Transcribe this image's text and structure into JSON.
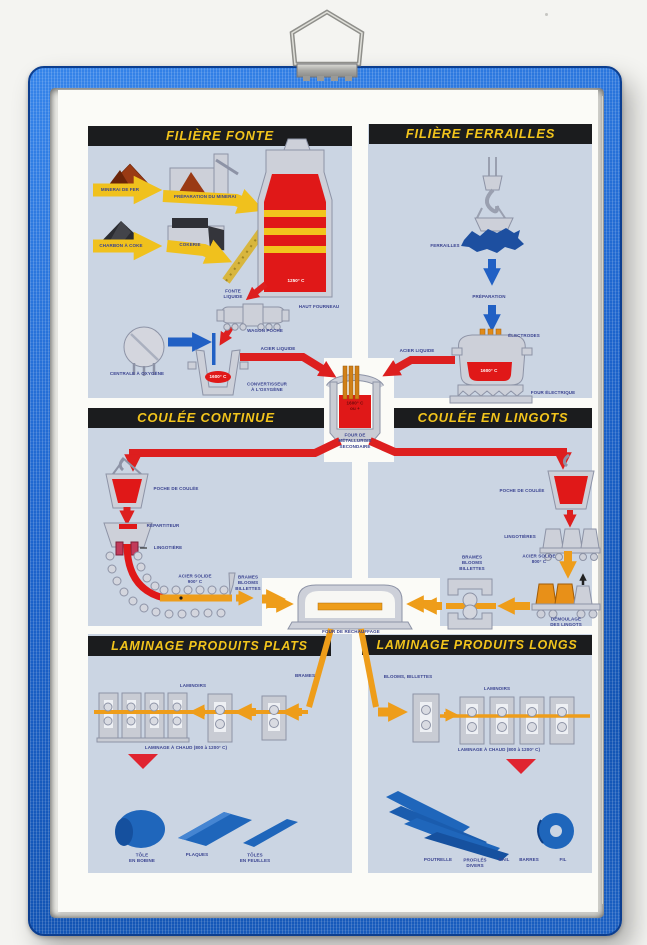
{
  "headers": {
    "fonte": "FILIÈRE FONTE",
    "ferrailles": "FILIÈRE FERRAILLES",
    "coulee_continue": "COULÉE CONTINUE",
    "coulee_lingots": "COULÉE EN LINGOTS",
    "laminage_plats": "LAMINAGE PRODUITS PLATS",
    "laminage_longs": "LAMINAGE PRODUITS LONGS"
  },
  "fonte": {
    "minerai": "MINERAI DE FER",
    "preparation": "PRÉPARATION DU MINERAI",
    "charbon": "CHARBON À COKE",
    "cokerie": "COKERIE",
    "haut_fourneau": "HAUT FOURNEAU",
    "temp_haut_fourneau": "1250° C",
    "fonte_liquide": "FONTE\nLIQUIDE",
    "wagon_poche": "WAGON POCHE",
    "centrale_oxygene": "CENTRALE À OXYGÈNE",
    "temp_convertisseur": "1600° C",
    "convertisseur": "CONVERTISSEUR\nÀ L'OXYGÈNE",
    "acier_liquide": "ACIER LIQUIDE"
  },
  "ferrailles": {
    "ferrailles": "FERRAILLES",
    "preparation": "PRÉPARATION",
    "electrodes": "ÉLECTRODES",
    "temp_four": "1600° C",
    "four_electrique": "FOUR ÉLECTRIQUE",
    "acier_liquide": "ACIER LIQUIDE"
  },
  "metallurgie": {
    "temp": "1600° C\nou +",
    "label": "FOUR DE\nMÉTALLURGIE\nSECONDAIRE"
  },
  "coulee_continue": {
    "poche": "POCHE DE COULÉE",
    "repartiteur": "RÉPARTITEUR",
    "lingotiere": "LINGOTIÈRE",
    "acier_solide": "ACIER SOLIDE\n900° C",
    "brames": "BRAMES\nBLOOMS\nBILLETTES"
  },
  "coulee_lingots": {
    "poche": "POCHE DE COULÉE",
    "lingotieres": "LINGOTIÈRES",
    "acier_solide": "ACIER SOLIDE\n800° C",
    "brames": "BRAMES\nBLOOMS\nBILLETTES",
    "demoulage": "DÉMOULAGE\nDES LINGOTS"
  },
  "rechauffage": {
    "label": "FOUR DE RÉCHAUFFAGE"
  },
  "plats": {
    "brames": "BRAMES",
    "laminoirs": "LAMINOIRS",
    "laminage_chaud": "LAMINAGE À CHAUD (800 à 1200° C)",
    "tole_bobine": "TÔLE\nEN BOBINE",
    "plaques": "PLAQUES",
    "toles_feuilles": "TÔLES\nEN FEUILLES"
  },
  "longs": {
    "blooms": "BLOOMS, BILLETTES",
    "laminoirs": "LAMINOIRS",
    "laminage_chaud": "LAMINAGE À CHAUD (800 à 1200° C)",
    "poutrelle": "POUTRELLE",
    "profiles": "PROFILÉS\nDIVERS",
    "rail": "RAIL",
    "barres": "BARRES",
    "fil": "FIL"
  },
  "colors": {
    "frame_blue": "#1d66cf",
    "panel_blue": "#cbd5e3",
    "header_bg": "#1b1c1e",
    "header_text": "#f2c41c",
    "arrow_red": "#dd1f1f",
    "arrow_orange": "#ee9d1a",
    "arrow_yellow": "#f0c11d",
    "arrow_blue": "#2160c4",
    "product_blue": "#1f66bb"
  }
}
